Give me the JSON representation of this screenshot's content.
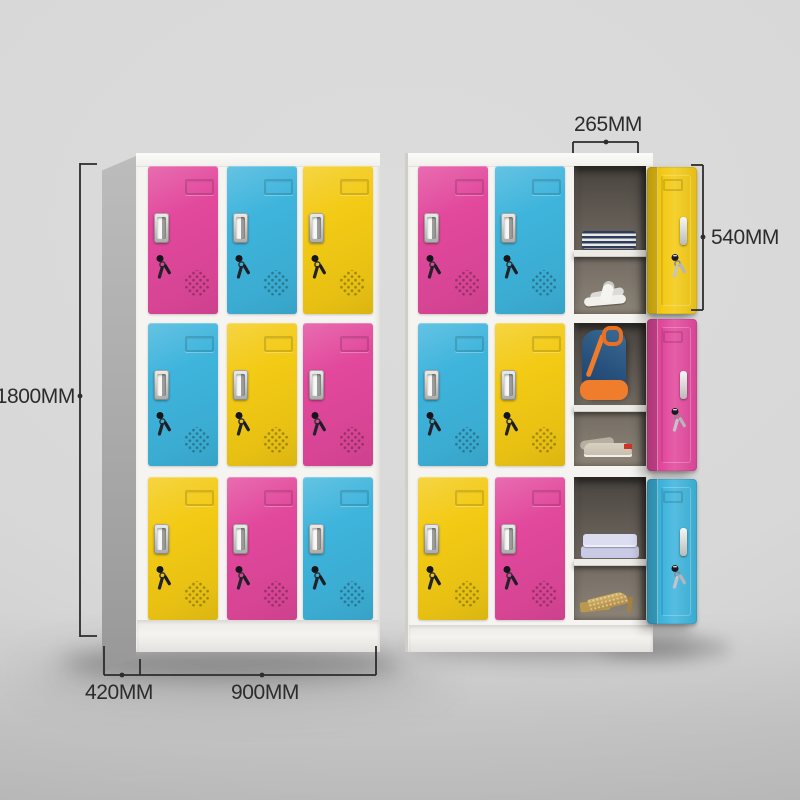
{
  "product": {
    "name": "nine-door-colorful-steel-locker",
    "views": [
      "closed-locker",
      "open-locker"
    ]
  },
  "colors": {
    "pink": "#e2489c",
    "blue": "#3eb4dc",
    "yellow": "#f3ca14",
    "frame": "#f5f4f0",
    "side_gray": "#a9a9a9",
    "background": "#d8d8d8",
    "interior": "#6a645c",
    "annotation": "#2c2c2c"
  },
  "annotations": {
    "height_label": "1800MM",
    "depth_label": "420MM",
    "width_label": "900MM",
    "door_width_label": "265MM",
    "compartment_height_label": "540MM"
  },
  "left_locker": {
    "grid": [
      [
        "pink",
        "blue",
        "yellow"
      ],
      [
        "blue",
        "yellow",
        "pink"
      ],
      [
        "yellow",
        "pink",
        "blue"
      ]
    ]
  },
  "right_locker": {
    "closed_grid": [
      [
        "pink",
        "blue"
      ],
      [
        "blue",
        "yellow"
      ],
      [
        "yellow",
        "pink"
      ]
    ],
    "open_column": [
      {
        "door": "yellow",
        "top_item": "folded-striped-towels",
        "bottom_item": "white-slippers"
      },
      {
        "door": "pink",
        "top_item": "backpack",
        "bottom_item": "sneakers"
      },
      {
        "door": "blue",
        "top_item": "folded-shirts",
        "bottom_item": "high-heels"
      }
    ]
  }
}
